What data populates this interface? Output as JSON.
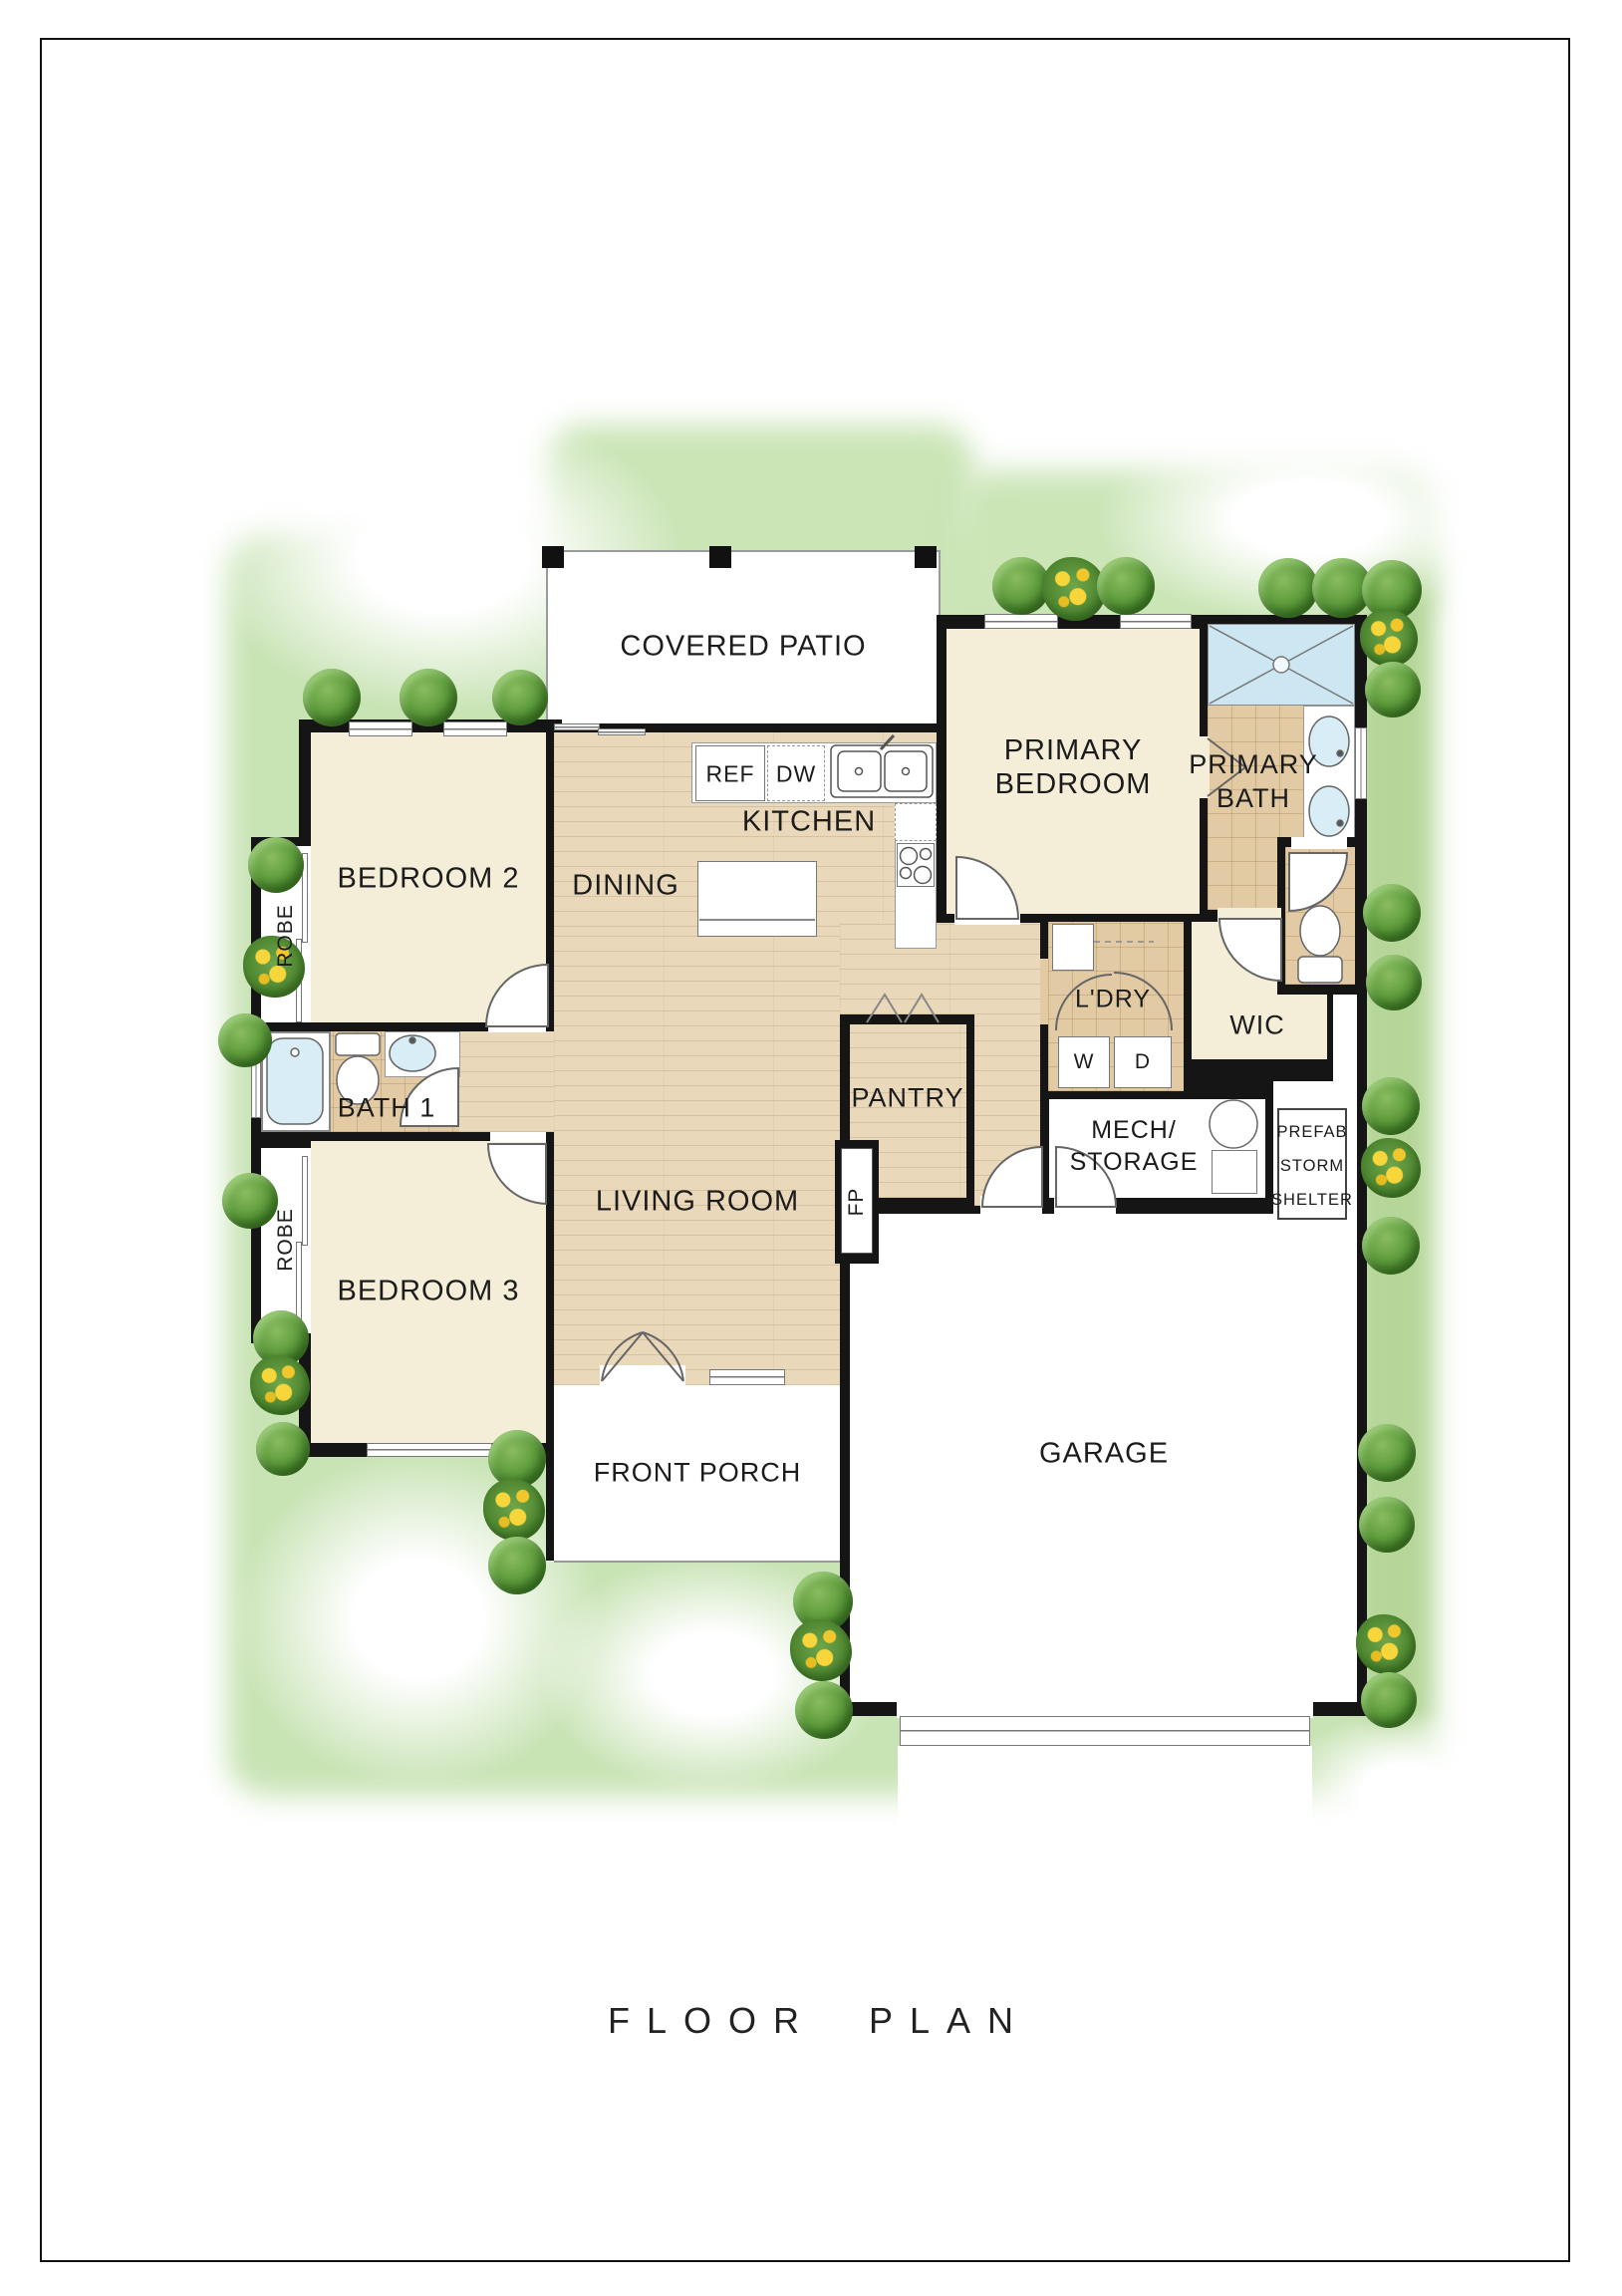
{
  "title": "FLOOR PLAN",
  "rooms": {
    "covered_patio": "COVERED PATIO",
    "bedroom2": "BEDROOM 2",
    "bedroom3": "BEDROOM 3",
    "bath1": "BATH 1",
    "robe": "ROBE",
    "dining": "DINING",
    "kitchen": "KITCHEN",
    "living_room": "LIVING ROOM",
    "pantry": "PANTRY",
    "laundry": "L'DRY",
    "wic": "WIC",
    "garage": "GARAGE",
    "front_porch": "FRONT PORCH",
    "primary_bedroom": {
      "line1": "PRIMARY",
      "line2": "BEDROOM"
    },
    "primary_bath": {
      "line1": "PRIMARY",
      "line2": "BATH"
    },
    "mech": {
      "line1": "MECH/",
      "line2": "STORAGE"
    },
    "shelter": {
      "line1": "PREFAB",
      "line2": "STORM",
      "line3": "SHELTER"
    }
  },
  "fixtures": {
    "fridge": "REF",
    "dishwasher": "DW",
    "washer": "W",
    "dryer": "D",
    "fireplace": "FP"
  },
  "colors": {
    "wall": "#151515",
    "lawn": "#c8e3b4",
    "wood_floor": "#e9d8ba",
    "tile_floor": "#e2cba4",
    "room_cream": "#f4eed9",
    "shower_blue": "#cde7f2"
  }
}
